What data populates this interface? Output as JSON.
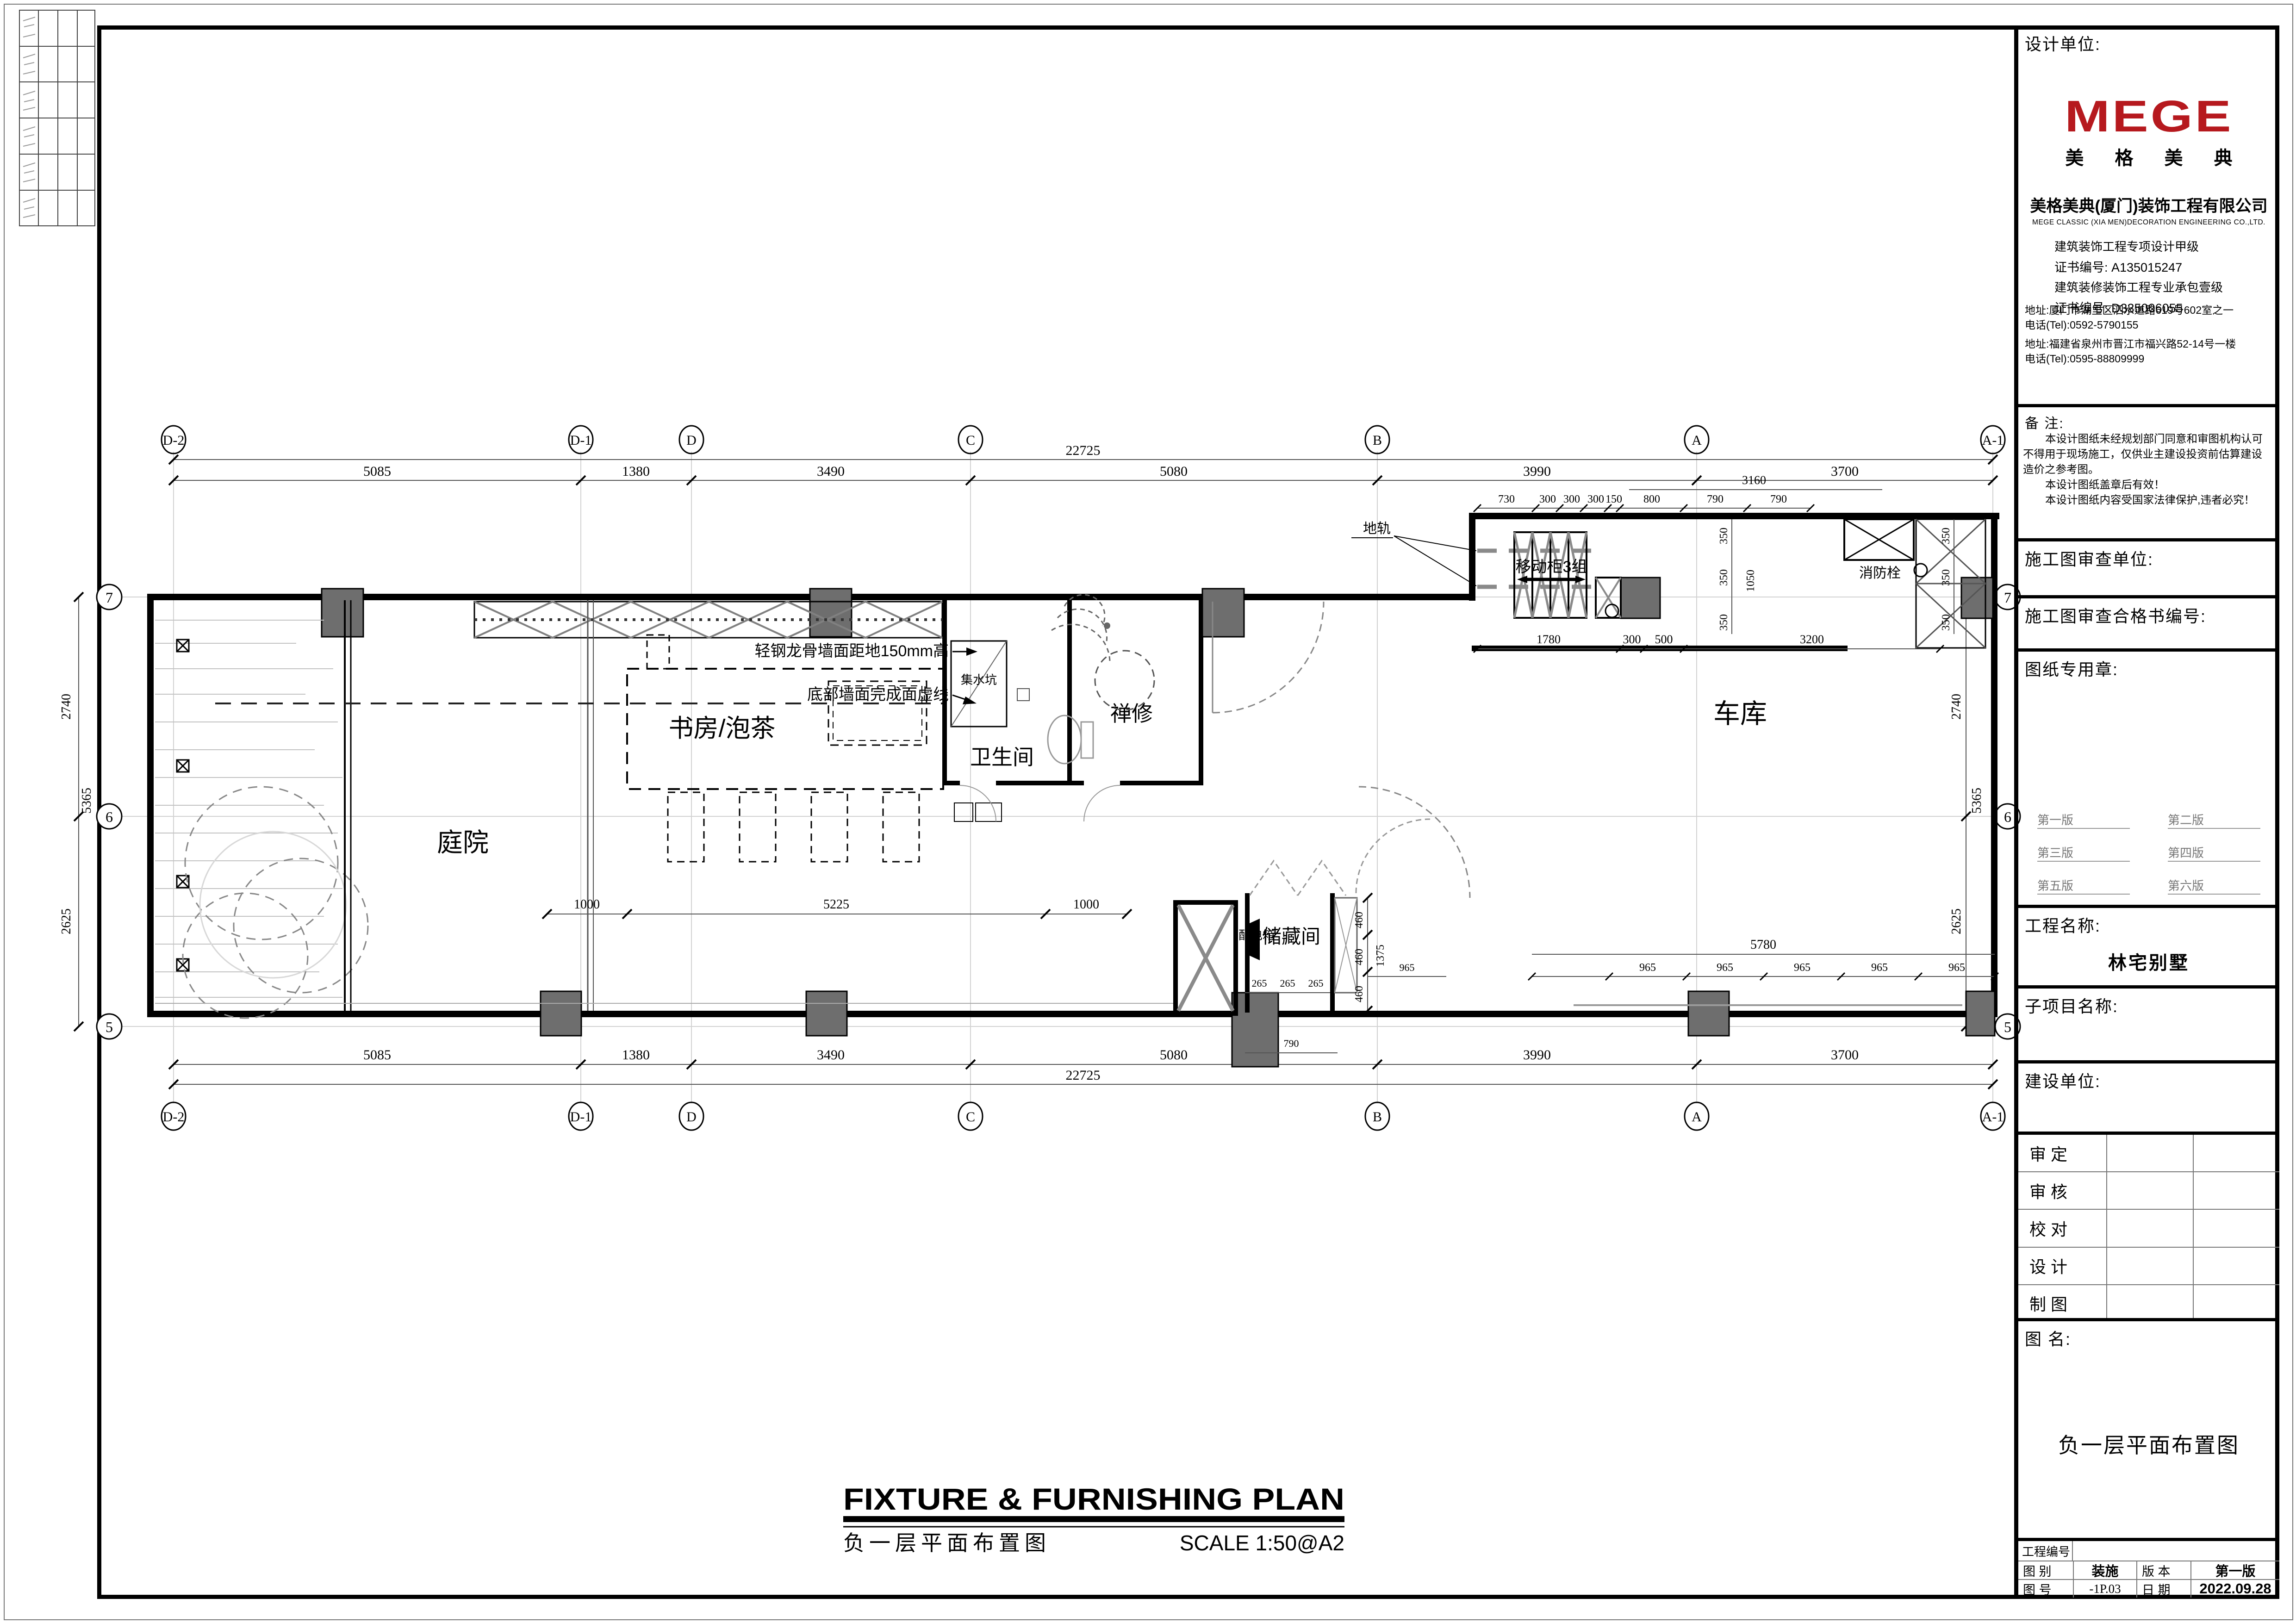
{
  "frame": {
    "note": "architectural drawing sheet"
  },
  "title_block": {
    "design_unit_label": "设计单位:",
    "logo_text": "MEGE",
    "logo_sub": "美 格 美 典",
    "company_cn": "美格美典(厦门)装饰工程有限公司",
    "company_en": "MEGE CLASSIC (XIA MEN)DECORATION ENGINEERING CO.,LTD.",
    "cert1": "建筑装饰工程专项设计甲级",
    "cert1_no": "证书编号: A135015247",
    "cert2": "建筑装修装饰工程专业承包壹级",
    "cert2_no": "证书编号: D335006055",
    "addr1": "地址:厦门市湖里区泗水道路619号602室之一",
    "tel1": "电话(Tel):0592-5790155",
    "addr2": "地址:福建省泉州市晋江市福兴路52-14号一楼",
    "tel2": "电话(Tel):0595-88809999",
    "note_label": "备  注:",
    "note_lines": [
      "本设计图纸未经规划部门同意和审图机构认可",
      "不得用于现场施工，仅供业主建设投资前估算建设",
      "造价之参考图。",
      "本设计图纸盖章后有效！",
      "本设计图纸内容受国家法律保护,违者必究！"
    ],
    "review_unit_label": "施工图审查单位:",
    "review_no_label": "施工图审查合格书编号:",
    "stamp_label": "图纸专用章:",
    "versions": [
      "第一版",
      "第二版",
      "第三版",
      "第四版",
      "第五版",
      "第六版"
    ],
    "project_name_label": "工程名称:",
    "project_name": "林宅别墅",
    "subproject_label": "子项目名称:",
    "client_label": "建设单位:",
    "sign_rows": [
      "审    定",
      "审    核",
      "校    对",
      "设    计",
      "制    图"
    ],
    "drawing_name_label": "图    名:",
    "drawing_name": "负一层平面布置图",
    "project_no_label": "工程编号",
    "type_label": "图    别",
    "type_value": "装施",
    "version_label": "版    本",
    "version_value": "第一版",
    "no_label": "图    号",
    "no_value": "-1P.03",
    "date_label": "日    期",
    "date_value": "2022.09.28"
  },
  "plan": {
    "rooms": {
      "courtyard": "庭院",
      "study": "书房/泡茶",
      "bath": "卫生间",
      "meditation": "禅修",
      "garage": "车库",
      "storage": "储藏间"
    },
    "labels": {
      "sump": "集水坑",
      "dist_box": "配电箱",
      "ground_rail": "地轨",
      "mobile_cabinet": "移动柜3组",
      "hydrant": "消防栓",
      "anno_wall": "轻钢龙骨墙面距地150mm高",
      "anno_dash": "底部墙面完成面虚线"
    },
    "grid_cols": [
      "D-2",
      "D-1",
      "D",
      "C",
      "B",
      "A",
      "A-1"
    ],
    "grid_rows": [
      "7",
      "6",
      "5"
    ],
    "dims_h": [
      "5085",
      "1380",
      "3490",
      "5080",
      "3990",
      "3700"
    ],
    "dim_total_h": "22725",
    "dims_v": [
      "2740",
      "2625"
    ],
    "dim_total_v": "5365",
    "garage_top_dims": [
      "730",
      "300",
      "300",
      "300",
      "150",
      "800",
      "790",
      "790"
    ],
    "garage_dim_3160": "3160",
    "garage_mid_dims": [
      "1780",
      "300",
      "500",
      "3200"
    ],
    "v350": "350",
    "v1050": "1050",
    "storage_v_dims": [
      "460",
      "460",
      "460"
    ],
    "storage_1375": "1375",
    "storage_h_dims": [
      "265",
      "265",
      "265"
    ],
    "storage_790": "790",
    "storage_965": "965",
    "garage_bottom_total": "5780",
    "garage_bottom_seg": "965",
    "study_dims": [
      "1000",
      "5225",
      "1000"
    ]
  },
  "footer": {
    "title_en": "FIXTURE  &  FURNISHING  PLAN",
    "title_cn": "负一层平面布置图",
    "scale": "SCALE    1:50@A2"
  },
  "colors": {
    "logo_red": "#b6191e",
    "wall_black": "#000000",
    "column_gray": "#6e6e6e"
  }
}
